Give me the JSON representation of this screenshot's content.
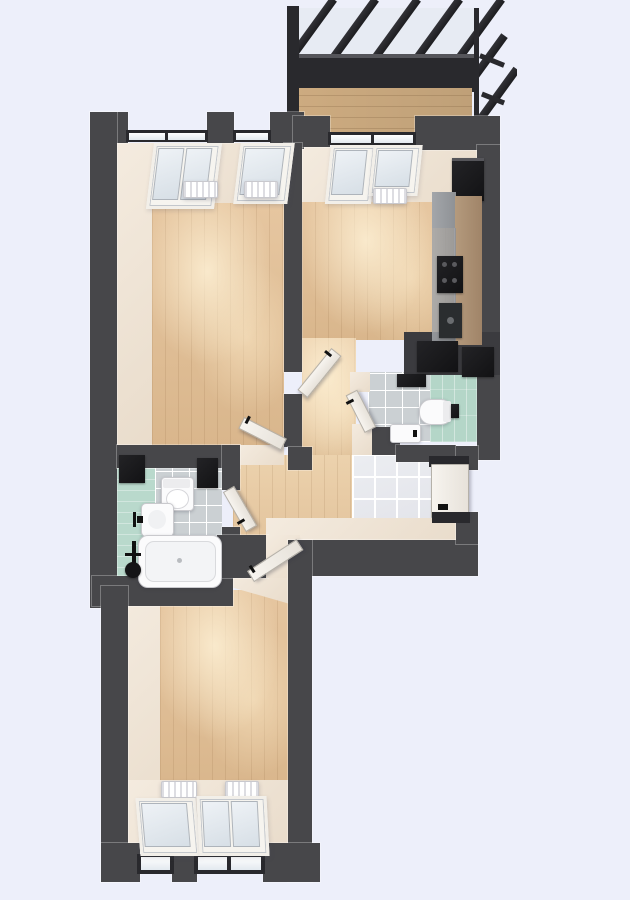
{
  "scene": {
    "kind": "apartment-floor-plan-3d-render",
    "view": "top-down",
    "visible_text": "none"
  },
  "palette": {
    "background": "#edeffa",
    "wall": "#47474a",
    "wall_dark": "#29292d",
    "wood_base": "#e6c6a0",
    "wood_shade": "#d9b68c",
    "balcony_wood": "#cdab80",
    "cream": "#f4ebdf",
    "cream_deep": "#e9dccb",
    "mint": "#b9d9cc",
    "mint_wc": "#b4d6c8",
    "tile_gray": "#cbd0d3",
    "tile_marble": "#e3e4ea",
    "fixture_white": "#fbfbfc",
    "black": "#121214",
    "counter_tan": "#b49a7d",
    "cabinet_gray": "#a3a6aa",
    "glass": "#e7ebf3"
  },
  "rooms": [
    {
      "name": "balcony",
      "features": [
        "glazed-roof-rafters",
        "railing",
        "wood-plank-floor"
      ]
    },
    {
      "name": "living-room",
      "features": [
        "two-windows",
        "two-radiators",
        "wood-floor",
        "door-to-hall"
      ]
    },
    {
      "name": "kitchen",
      "features": [
        "balcony-door",
        "radiator",
        "tall-cabinet",
        "counter-run",
        "cooktop",
        "sink",
        "two-dark-counters",
        "door-to-hall"
      ]
    },
    {
      "name": "wc",
      "features": [
        "mint-tile-wall",
        "gray-tile-floor",
        "toilet",
        "washbasin",
        "towel-shelf",
        "flush-plate",
        "door"
      ]
    },
    {
      "name": "hallway",
      "features": [
        "wood-floor",
        "marble-tile-entry",
        "entrance-door",
        "cream-step"
      ]
    },
    {
      "name": "bathroom",
      "features": [
        "mint-floor",
        "gray-tiles",
        "bathtub",
        "shower-set",
        "washbasin",
        "toilet",
        "two-dark-cabinets",
        "door"
      ]
    },
    {
      "name": "bedroom",
      "features": [
        "two-windows",
        "two-radiators",
        "wood-floor",
        "door-to-hall"
      ]
    }
  ],
  "doors": [
    {
      "name": "living-room-door",
      "state": "open"
    },
    {
      "name": "kitchen-door",
      "state": "open"
    },
    {
      "name": "wc-door",
      "state": "open"
    },
    {
      "name": "bathroom-door",
      "state": "open"
    },
    {
      "name": "bedroom-door",
      "state": "open"
    },
    {
      "name": "entrance-door",
      "state": "closed"
    }
  ]
}
